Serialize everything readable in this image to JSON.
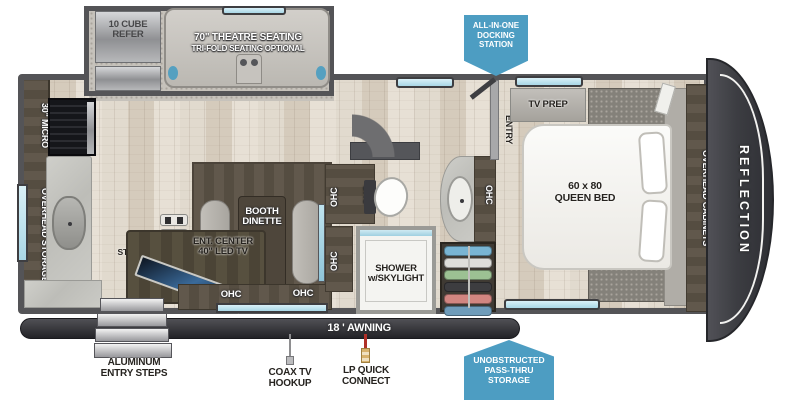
{
  "model": "REFLECTION",
  "badges": {
    "docking": [
      "ALL-IN-ONE",
      "DOCKING",
      "STATION"
    ],
    "passthru": [
      "UNOBSTRUCTED",
      "PASS-THRU",
      "STORAGE"
    ]
  },
  "slide": {
    "refer": [
      "10 CUBE",
      "REFER"
    ],
    "sofa_line1": "70\" THEATRE SEATING",
    "sofa_line2": "TRI-FOLD SEATING OPTIONAL"
  },
  "kitchen": {
    "micro": "30\" MICRO",
    "overhead": "OVERHEAD STORAGE",
    "shoe": [
      "SHOE",
      "STORAGE"
    ]
  },
  "living": {
    "dinette": [
      "BOOTH",
      "DINETTE"
    ],
    "ent": [
      "ENT. CENTER",
      "40\" LED TV"
    ],
    "ohc": "OHC"
  },
  "bath": {
    "shower": [
      "SHOWER",
      "w/SKYLIGHT"
    ]
  },
  "bedroom": {
    "entry": "ENTRY",
    "tvprep": "TV PREP",
    "bed": [
      "60 x 80",
      "QUEEN BED"
    ],
    "cabinets": "OVERHEAD CABINETS"
  },
  "exterior": {
    "awning": "18 ' AWNING",
    "steps": [
      "ALUMINUM",
      "ENTRY STEPS"
    ],
    "coax": [
      "COAX TV",
      "HOOKUP"
    ],
    "lp": [
      "LP QUICK",
      "CONNECT"
    ]
  },
  "colors": {
    "badge_blue": "#4d9dc2",
    "wall_gray": "#545457",
    "cabinet_brown": "#5d5549",
    "window_blue": "#c3e6f0",
    "awning_dark": "#2b2b2f"
  }
}
